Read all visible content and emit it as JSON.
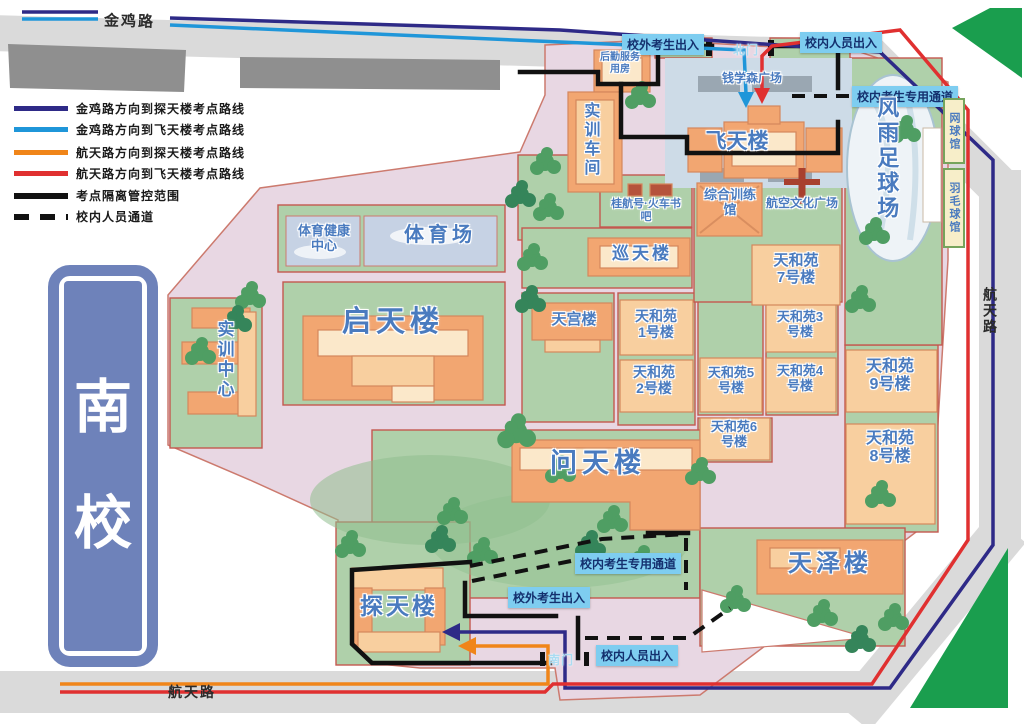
{
  "legend": {
    "items": [
      {
        "label": "金鸡路方向到探天楼考点路线",
        "color": "#2e2a87",
        "style": "solid"
      },
      {
        "label": "金鸡路方向到飞天楼考点路线",
        "color": "#1f96d9",
        "style": "solid"
      },
      {
        "label": "航天路方向到探天楼考点路线",
        "color": "#f08519",
        "style": "solid"
      },
      {
        "label": "航天路方向到飞天楼考点路线",
        "color": "#e03030",
        "style": "solid"
      },
      {
        "label": "考点隔离管控范围",
        "color": "#111111",
        "style": "solid-thick"
      },
      {
        "label": "校内人员通道",
        "color": "#111111",
        "style": "dashed"
      }
    ]
  },
  "roads": {
    "top": "金鸡路",
    "right": "航天路",
    "bottom": "航天路"
  },
  "campus": {
    "name_chars": [
      "南",
      "校"
    ]
  },
  "gates": {
    "north": "北门",
    "south": "南门"
  },
  "entries": {
    "external_candidates": "校外考生出入",
    "internal_staff": "校内人员出入",
    "internal_candidates_channel": "校内考生专用通道"
  },
  "places": {
    "feitian": "飞天楼",
    "qianxuesen_guangchang": "钱学森广场",
    "houqin_fuwu": "后勤服务用房",
    "shixun_chejian": "实训车间",
    "guihang_shuba": "桂航号·火车书吧",
    "zonghe_xunlianguan": "综合训练馆",
    "hangkong_wenhua": "航空文化广场",
    "fengyu_zuqiuchang": "风雨足球场",
    "wangqiuguan": "网球馆",
    "yumaoqiuguan": "羽毛球馆",
    "tiyu_jiankang": "体育健康中心",
    "tiyuchang": "体育场",
    "xuntianlou": "巡天楼",
    "qitianlou": "启天楼",
    "shixun_zhongxin": "实训中心",
    "tiangonglou": "天宫楼",
    "tianheyuan_1": "天和苑1号楼",
    "tianheyuan_2": "天和苑2号楼",
    "tianheyuan_3": "天和苑3号楼",
    "tianheyuan_4": "天和苑4号楼",
    "tianheyuan_5": "天和苑5号楼",
    "tianheyuan_6": "天和苑6号楼",
    "tianheyuan_7": "天和苑7号楼",
    "tianheyuan_8": "天和苑8号楼",
    "tianheyuan_9": "天和苑9号楼",
    "wentianlou": "问天楼",
    "tantianlou": "探天楼",
    "tianzelou": "天泽楼"
  },
  "colors": {
    "route_jinji_tantian": "#2e2a87",
    "route_jinji_feitian": "#1f96d9",
    "route_hangtian_tantian": "#f08519",
    "route_hangtian_feitian": "#e03030",
    "isolation_line": "#111111",
    "campus_fill": "#e8d7e3",
    "green_zone": "#afd0aa",
    "building_orange": "#f2a671",
    "entry_tag_bg": "#7ecdf0"
  }
}
